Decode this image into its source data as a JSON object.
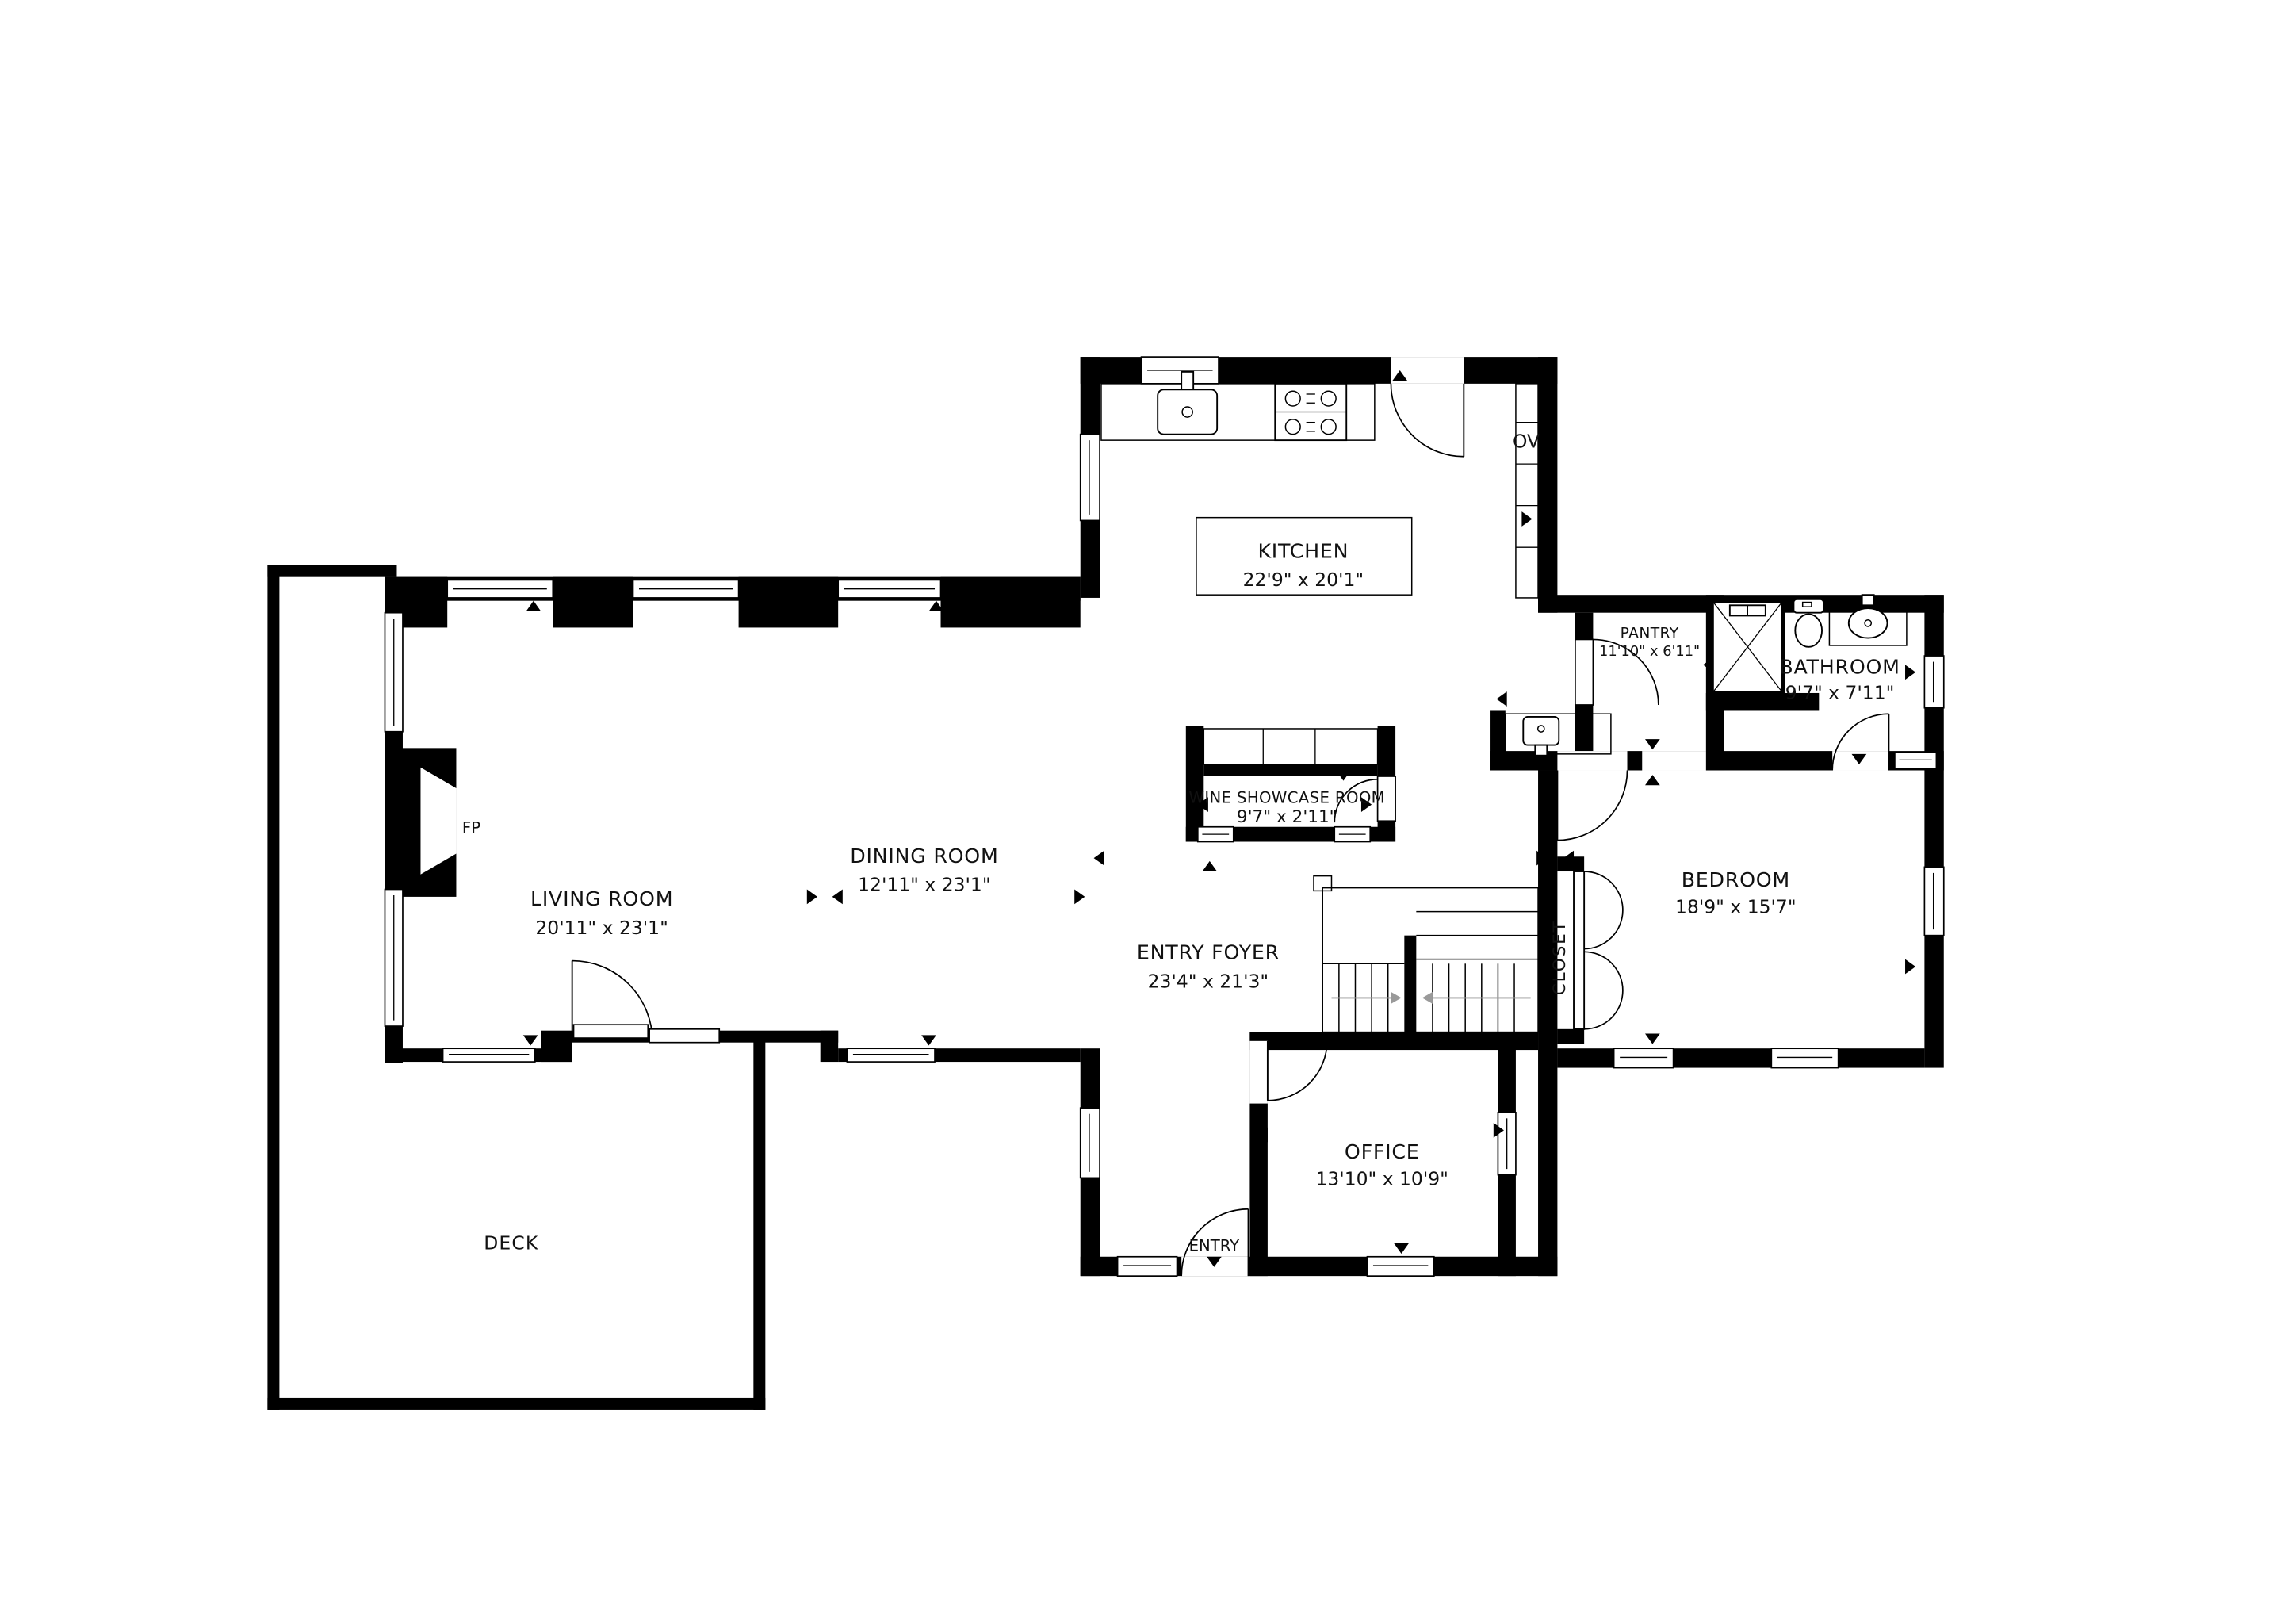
{
  "floorplan": {
    "title": "First floor plan",
    "rooms": {
      "kitchen": {
        "name": "KITCHEN",
        "dims": "22'9\" x 20'1\""
      },
      "living": {
        "name": "LIVING ROOM",
        "dims": "20'11\" x 23'1\""
      },
      "dining": {
        "name": "DINING ROOM",
        "dims": "12'11\" x 23'1\""
      },
      "foyer": {
        "name": "ENTRY FOYER",
        "dims": "23'4\" x 21'3\""
      },
      "wine": {
        "name": "WINE SHOWCASE ROOM",
        "dims": "9'7\" x 2'11\""
      },
      "pantry": {
        "name": "PANTRY",
        "dims": "11'10\" x 6'11\""
      },
      "bathroom": {
        "name": "BATHROOM",
        "dims": "9'7\" x 7'11\""
      },
      "bedroom": {
        "name": "BEDROOM",
        "dims": "18'9\" x 15'7\""
      },
      "office": {
        "name": "OFFICE",
        "dims": "13'10\" x 10'9\""
      },
      "closet": {
        "name": "CLOSET"
      },
      "deck": {
        "name": "DECK"
      },
      "entry": {
        "name": "ENTRY"
      }
    },
    "annotations": {
      "fireplace": "FP",
      "oven": "OV"
    },
    "colors": {
      "wall": "#000000",
      "background": "#ffffff",
      "stair_arrow": "#9a9a9a"
    }
  }
}
